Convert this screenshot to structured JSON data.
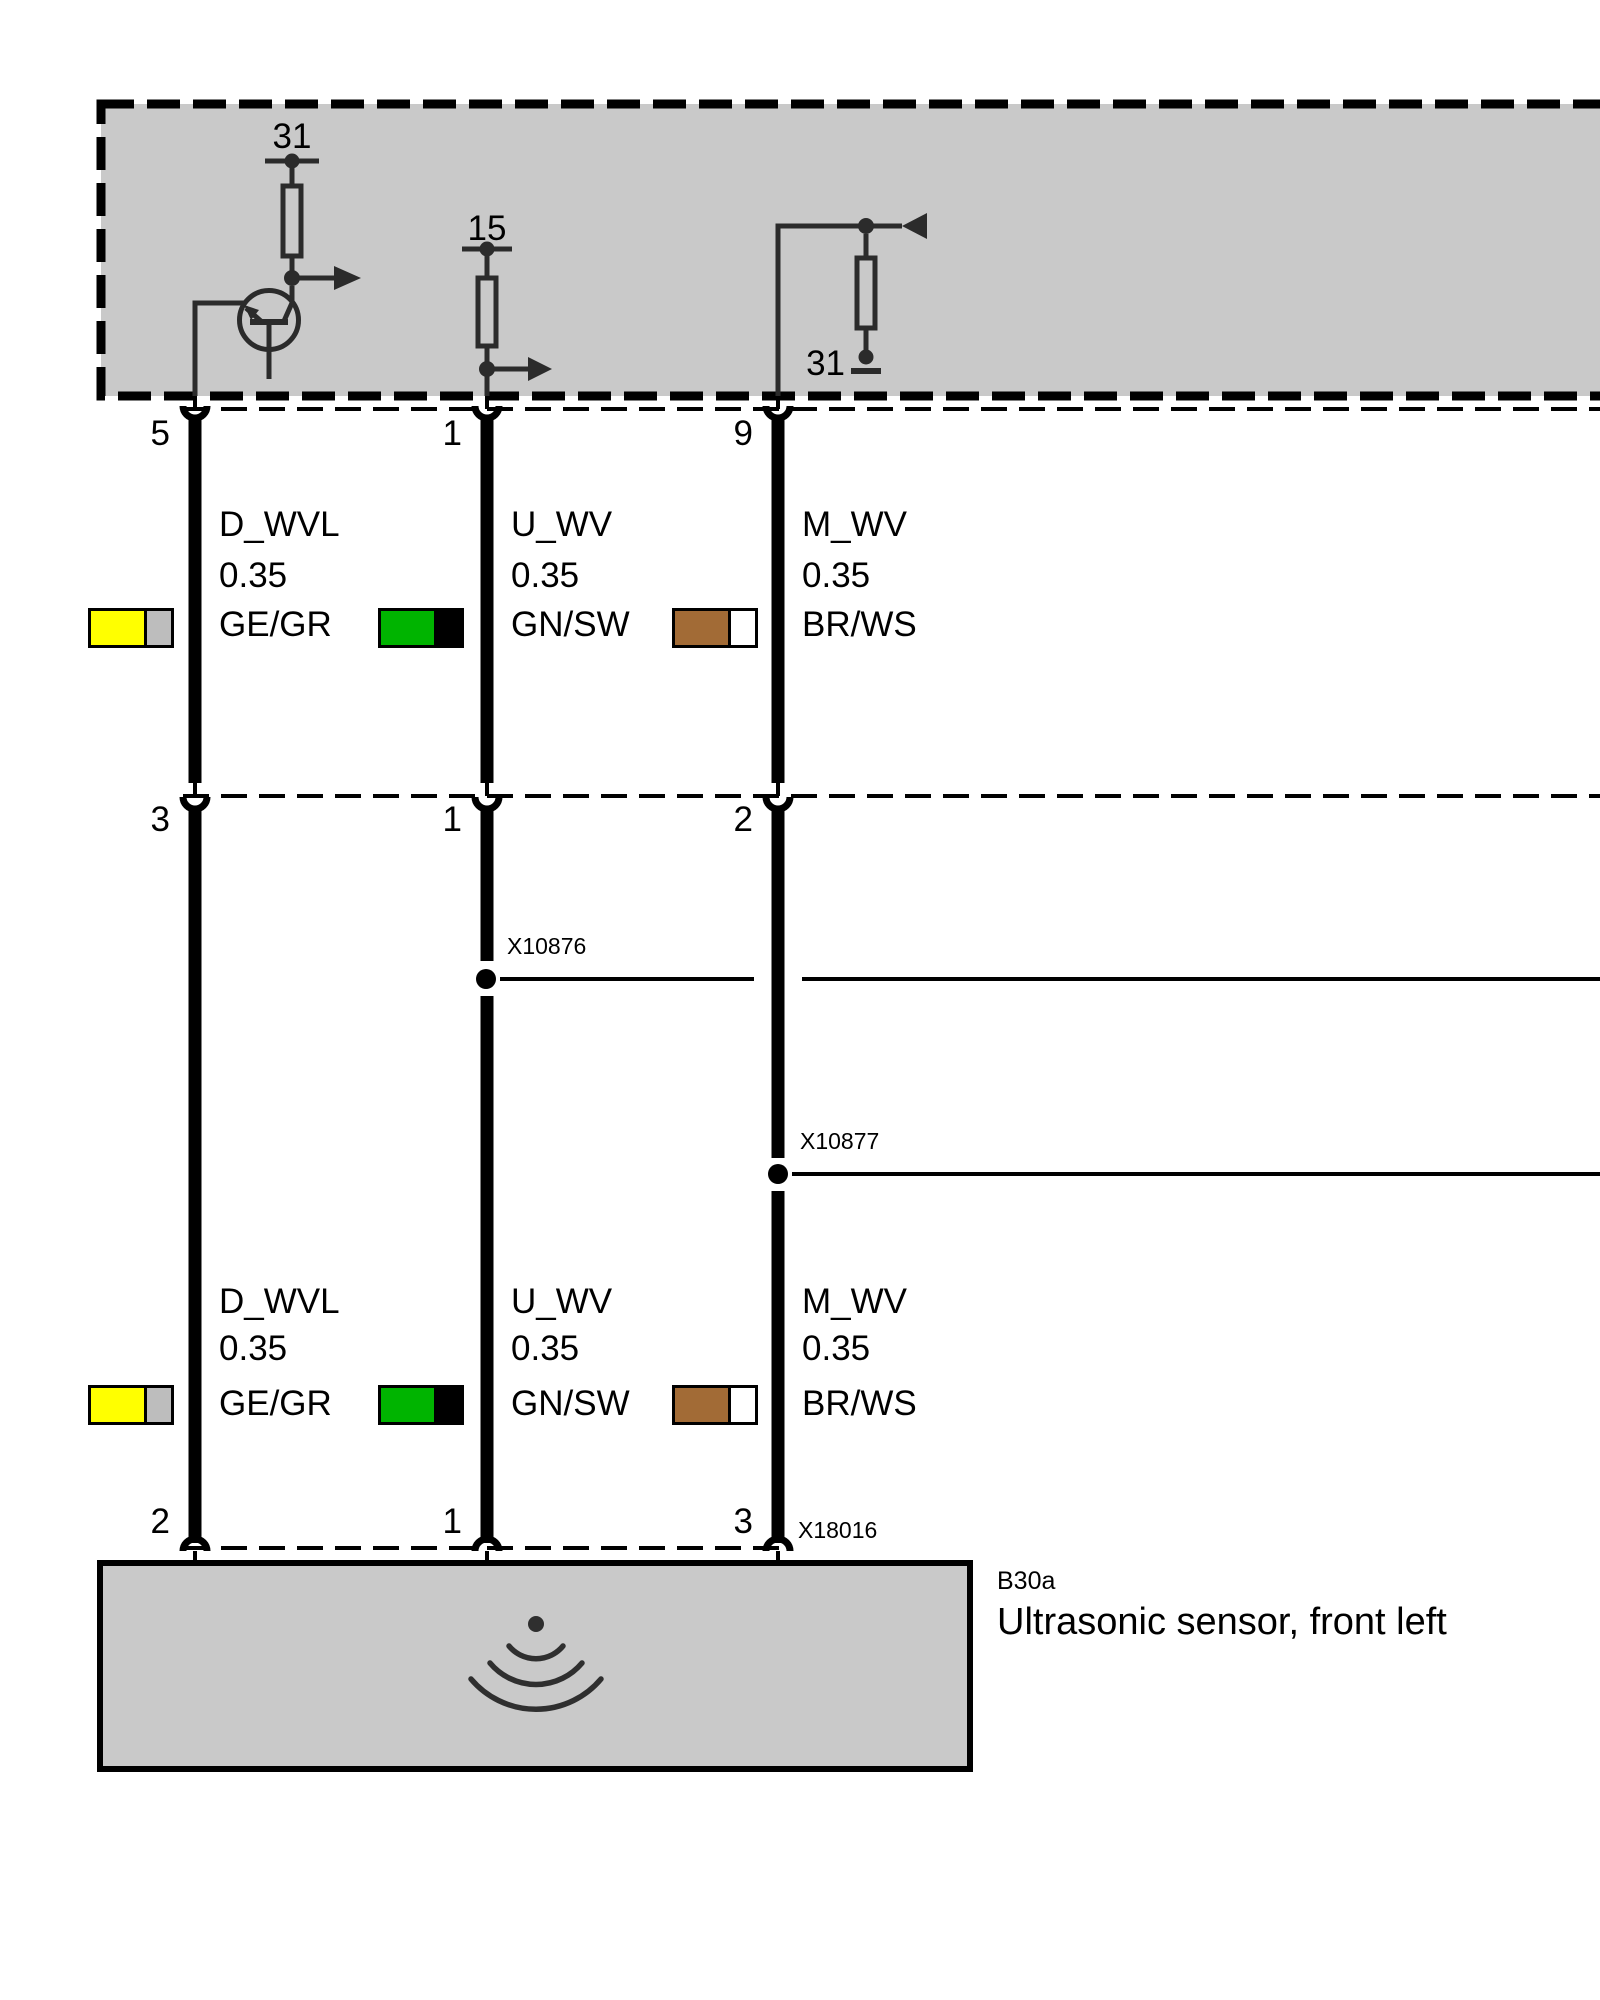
{
  "diagram": {
    "module": {
      "fill": "#c9c9c9",
      "terminal_31_top": "31",
      "terminal_15": "15",
      "terminal_31_right": "31"
    },
    "pins": {
      "top": [
        "5",
        "1",
        "9"
      ],
      "mid": [
        "3",
        "1",
        "2"
      ],
      "bottom": [
        "2",
        "1",
        "3"
      ]
    },
    "splices": {
      "x10876": "X10876",
      "x10877": "X10877"
    },
    "sensor_connector": "X18016",
    "wires": [
      {
        "signal": "D_WVL",
        "cross_section": "0.35",
        "color_code": "GE/GR",
        "color_main": "#ffff00",
        "color_stripe": "#bdbdbd"
      },
      {
        "signal": "U_WV",
        "cross_section": "0.35",
        "color_code": "GN/SW",
        "color_main": "#00b400",
        "color_stripe": "#000000"
      },
      {
        "signal": "M_WV",
        "cross_section": "0.35",
        "color_code": "BR/WS",
        "color_main": "#a26b36",
        "color_stripe": "#ffffff"
      }
    ],
    "sensor": {
      "code": "B30a",
      "name": "Ultrasonic sensor, front left"
    }
  }
}
